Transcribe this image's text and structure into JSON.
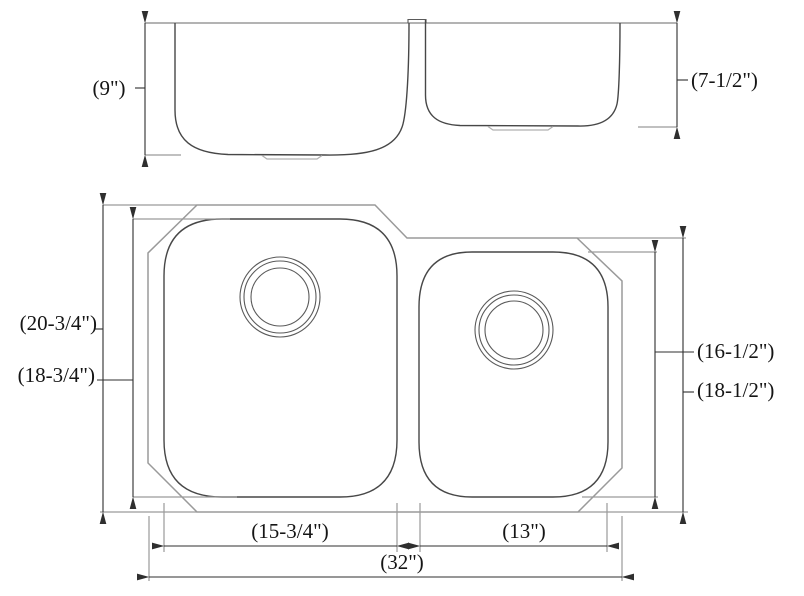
{
  "drawing": {
    "type": "technical-dimension-drawing",
    "subject": "double-bowl undermount kitchen sink, front elevation and plan view",
    "colors": {
      "background": "#ffffff",
      "flange_outline": "#9a9a9a",
      "bowl_outline": "#474747",
      "dimension_lines": "#2f2f2f",
      "text": "#151515"
    },
    "labels": {
      "elev_left_bowl_depth": "(9\")",
      "elev_right_bowl_depth": "(7-1/2\")",
      "plan_overall_height": "(20-3/4\")",
      "plan_left_bowl_height": "(18-3/4\")",
      "plan_right_bowl_height": "(16-1/2\")",
      "plan_right_flange_height": "(18-1/2\")",
      "plan_left_bowl_width": "(15-3/4\")",
      "plan_right_bowl_width": "(13\")",
      "plan_overall_width": "(32\")"
    }
  }
}
